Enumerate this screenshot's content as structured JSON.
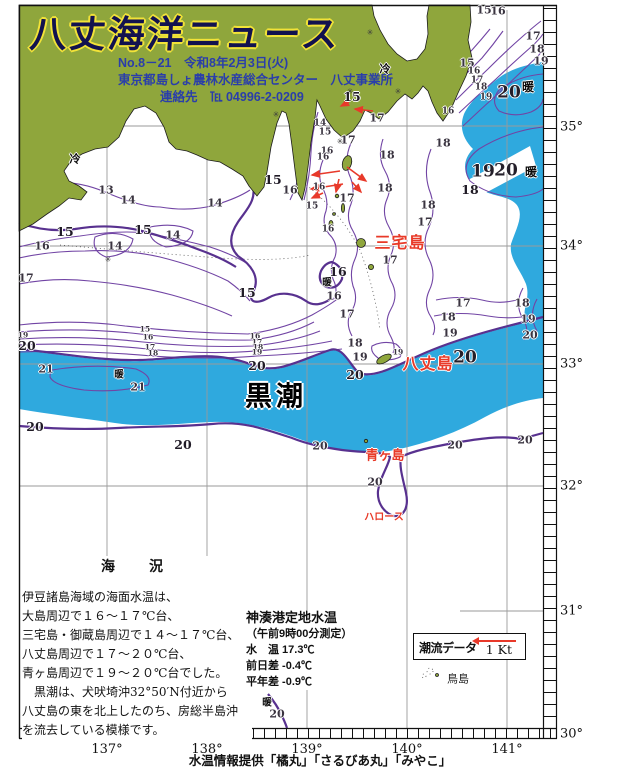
{
  "header": {
    "title": "八丈海洋ニュース",
    "issue_line": "No.8－21　令和8年2月3日(火)",
    "org_line": "東京都島しょ農林水産総合センター　八丈事業所",
    "contact_line": "連絡先　℡ 04996-2-0209"
  },
  "colors": {
    "land": "#8fa63c",
    "warm_water": "#2fa9de",
    "contour": "#7144a4",
    "contour_bold": "#58318f",
    "red_accent": "#e8392a",
    "header_text": "#2a3eaa",
    "title_outline": "#f2e338"
  },
  "map": {
    "lat_labels": [
      {
        "t": "35°",
        "y": 127
      },
      {
        "t": "34°",
        "y": 246
      },
      {
        "t": "33°",
        "y": 364
      },
      {
        "t": "32°",
        "y": 486
      },
      {
        "t": "31°",
        "y": 611
      },
      {
        "t": "30°",
        "y": 734
      }
    ],
    "lon_labels": [
      {
        "t": "137°",
        "x": 107
      },
      {
        "t": "138°",
        "x": 207
      },
      {
        "t": "139°",
        "x": 307
      },
      {
        "t": "140°",
        "x": 407
      },
      {
        "t": "141°",
        "x": 507
      }
    ],
    "labels": [
      {
        "t": "冷",
        "x": 75,
        "y": 160,
        "c": "cold",
        "n": "cold-label"
      },
      {
        "t": "冷",
        "x": 385,
        "y": 70,
        "c": "cold",
        "n": "cold-label"
      },
      {
        "t": "13",
        "x": 106,
        "y": 190
      },
      {
        "t": "14",
        "x": 128,
        "y": 200
      },
      {
        "t": "14",
        "x": 215,
        "y": 203
      },
      {
        "t": "14",
        "x": 173,
        "y": 235
      },
      {
        "t": "14",
        "x": 115,
        "y": 246
      },
      {
        "t": "15",
        "x": 65,
        "y": 232,
        "c": "nb"
      },
      {
        "t": "15",
        "x": 143,
        "y": 230,
        "c": "nb"
      },
      {
        "t": "15",
        "x": 247,
        "y": 293,
        "c": "nb"
      },
      {
        "t": "15",
        "x": 273,
        "y": 180,
        "c": "nb"
      },
      {
        "t": "16",
        "x": 42,
        "y": 246
      },
      {
        "t": "17",
        "x": 26,
        "y": 278
      },
      {
        "t": "14",
        "x": 320,
        "y": 124,
        "c": "sm"
      },
      {
        "t": "15",
        "x": 325,
        "y": 133,
        "c": "sm"
      },
      {
        "t": "16",
        "x": 327,
        "y": 152,
        "c": "sm"
      },
      {
        "t": "16",
        "x": 319,
        "y": 188,
        "c": "sm"
      },
      {
        "t": "15",
        "x": 352,
        "y": 97,
        "c": "nb"
      },
      {
        "t": "17",
        "x": 348,
        "y": 140
      },
      {
        "t": "17",
        "x": 377,
        "y": 118
      },
      {
        "t": "15",
        "x": 312,
        "y": 207,
        "c": "sm"
      },
      {
        "t": "16",
        "x": 290,
        "y": 190
      },
      {
        "t": "16",
        "x": 323,
        "y": 158,
        "c": "sm"
      },
      {
        "t": "16",
        "x": 328,
        "y": 230,
        "c": "sm"
      },
      {
        "t": "17",
        "x": 347,
        "y": 198
      },
      {
        "t": "18",
        "x": 387,
        "y": 155
      },
      {
        "t": "18",
        "x": 385,
        "y": 188
      },
      {
        "t": "18",
        "x": 428,
        "y": 205
      },
      {
        "t": "17",
        "x": 425,
        "y": 222
      },
      {
        "t": "17",
        "x": 390,
        "y": 260
      },
      {
        "t": "16",
        "x": 338,
        "y": 272,
        "c": "nb"
      },
      {
        "t": "暖",
        "x": 327,
        "y": 283,
        "c": "warm",
        "n": "warm-label"
      },
      {
        "t": "16",
        "x": 334,
        "y": 296
      },
      {
        "t": "17",
        "x": 347,
        "y": 314
      },
      {
        "t": "18",
        "x": 355,
        "y": 343
      },
      {
        "t": "19",
        "x": 360,
        "y": 357
      },
      {
        "t": "19",
        "x": 398,
        "y": 352,
        "c": "tiny"
      },
      {
        "t": "15",
        "x": 484,
        "y": 10
      },
      {
        "t": "16",
        "x": 498,
        "y": 11
      },
      {
        "t": "17",
        "x": 533,
        "y": 36
      },
      {
        "t": "18",
        "x": 537,
        "y": 49
      },
      {
        "t": "19",
        "x": 541,
        "y": 61
      },
      {
        "t": "15",
        "x": 467,
        "y": 63
      },
      {
        "t": "16",
        "x": 474,
        "y": 72,
        "c": "sm"
      },
      {
        "t": "17",
        "x": 477,
        "y": 81,
        "c": "sm"
      },
      {
        "t": "18",
        "x": 481,
        "y": 88,
        "c": "sm"
      },
      {
        "t": "19",
        "x": 486,
        "y": 98,
        "c": "sm"
      },
      {
        "t": "20",
        "x": 509,
        "y": 93,
        "c": "big"
      },
      {
        "t": "暖",
        "x": 528,
        "y": 87,
        "c": "warmbig",
        "n": "warm-label"
      },
      {
        "t": "16",
        "x": 448,
        "y": 112,
        "c": "sm"
      },
      {
        "t": "18",
        "x": 443,
        "y": 143
      },
      {
        "t": "19",
        "x": 483,
        "y": 172,
        "c": "big"
      },
      {
        "t": "20",
        "x": 506,
        "y": 171,
        "c": "big"
      },
      {
        "t": "暖",
        "x": 531,
        "y": 172,
        "c": "warmbig",
        "n": "warm-label"
      },
      {
        "t": "18",
        "x": 470,
        "y": 190,
        "c": "nb"
      },
      {
        "t": "18",
        "x": 522,
        "y": 303
      },
      {
        "t": "19",
        "x": 528,
        "y": 319
      },
      {
        "t": "17",
        "x": 463,
        "y": 303
      },
      {
        "t": "18",
        "x": 448,
        "y": 317
      },
      {
        "t": "19",
        "x": 450,
        "y": 333
      },
      {
        "t": "20",
        "x": 530,
        "y": 335
      },
      {
        "t": "15",
        "x": 145,
        "y": 329,
        "c": "tiny"
      },
      {
        "t": "16",
        "x": 148,
        "y": 337,
        "c": "tiny"
      },
      {
        "t": "17",
        "x": 150,
        "y": 347,
        "c": "tiny"
      },
      {
        "t": "18",
        "x": 153,
        "y": 353,
        "c": "tiny"
      },
      {
        "t": "16",
        "x": 255,
        "y": 336,
        "c": "tiny"
      },
      {
        "t": "17",
        "x": 257,
        "y": 342,
        "c": "tiny"
      },
      {
        "t": "18",
        "x": 258,
        "y": 347,
        "c": "tiny"
      },
      {
        "t": "19",
        "x": 257,
        "y": 352,
        "c": "tiny"
      },
      {
        "t": "20",
        "x": 257,
        "y": 366,
        "c": "nb"
      },
      {
        "t": "19",
        "x": 23,
        "y": 335,
        "c": "tiny"
      },
      {
        "t": "20",
        "x": 27,
        "y": 346,
        "c": "nb"
      },
      {
        "t": "21",
        "x": 46,
        "y": 369
      },
      {
        "t": "暖",
        "x": 119,
        "y": 375,
        "c": "warm",
        "n": "warm-label"
      },
      {
        "t": "21",
        "x": 138,
        "y": 387
      },
      {
        "t": "20",
        "x": 35,
        "y": 427,
        "c": "nb"
      },
      {
        "t": "20",
        "x": 183,
        "y": 445,
        "c": "nb"
      },
      {
        "t": "20",
        "x": 355,
        "y": 375,
        "c": "nb"
      },
      {
        "t": "20",
        "x": 465,
        "y": 358,
        "c": "big"
      },
      {
        "t": "黒潮",
        "x": 276,
        "y": 397,
        "c": "kuro",
        "n": "kuroshio-label"
      },
      {
        "t": "20",
        "x": 320,
        "y": 446
      },
      {
        "t": "20",
        "x": 455,
        "y": 445
      },
      {
        "t": "20",
        "x": 525,
        "y": 440
      },
      {
        "t": "20",
        "x": 375,
        "y": 482
      },
      {
        "t": "暖",
        "x": 267,
        "y": 703,
        "c": "warm",
        "n": "warm-label"
      },
      {
        "t": "20",
        "x": 277,
        "y": 714
      },
      {
        "t": "三宅島",
        "x": 400,
        "y": 244,
        "c": "red15",
        "n": "island-label-miyakejima"
      },
      {
        "t": "八丈島",
        "x": 428,
        "y": 365,
        "c": "red15",
        "n": "island-label-hachijojima"
      },
      {
        "t": "青ヶ島",
        "x": 385,
        "y": 455,
        "c": "red13",
        "n": "island-label-aogashima"
      },
      {
        "t": "ハロース",
        "x": 384,
        "y": 518,
        "c": "red10",
        "n": "island-label-harosu"
      },
      {
        "t": "鳥島",
        "x": 458,
        "y": 679,
        "c": "blk",
        "n": "island-label-torishima"
      },
      {
        "t": "✳",
        "x": 350,
        "y": 92,
        "c": "star",
        "n": "station-marker"
      },
      {
        "t": "✳",
        "x": 276,
        "y": 115,
        "c": "star",
        "n": "station-marker"
      },
      {
        "t": "✳",
        "x": 108,
        "y": 260,
        "c": "star",
        "n": "station-marker"
      },
      {
        "t": "✳",
        "x": 398,
        "y": 92,
        "c": "star",
        "n": "station-marker"
      },
      {
        "t": "✳",
        "x": 370,
        "y": 33,
        "c": "star",
        "n": "station-marker"
      },
      {
        "t": "✳",
        "x": 340,
        "y": 142,
        "c": "star",
        "n": "station-marker"
      }
    ]
  },
  "sea_report": {
    "heading": "海　況",
    "lines": [
      "伊豆諸島海域の海面水温は、",
      "大島周辺で１６～１７℃台、",
      "三宅島・御蔵島周辺で１４～１７℃台、",
      "八丈島周辺で１７～２０℃台、",
      "青ヶ島周辺で１９～２０℃台でした。",
      "　黒潮は、犬吠埼沖32°50′N付近から",
      "八丈島の東を北上したのち、房総半島沖",
      "を流去している模様です。"
    ]
  },
  "kaminato": {
    "heading": "神湊港定地水温",
    "lines": [
      "（午前9時00分測定）",
      "水　温 17.3℃",
      "前日差 -0.4℃",
      "平年差 -0.9℃"
    ]
  },
  "current_box": {
    "label": "潮流データ",
    "scale": "1 Kt"
  },
  "footer": {
    "credit": "水温情報提供「橘丸」「さるびあ丸」「みやこ」"
  }
}
